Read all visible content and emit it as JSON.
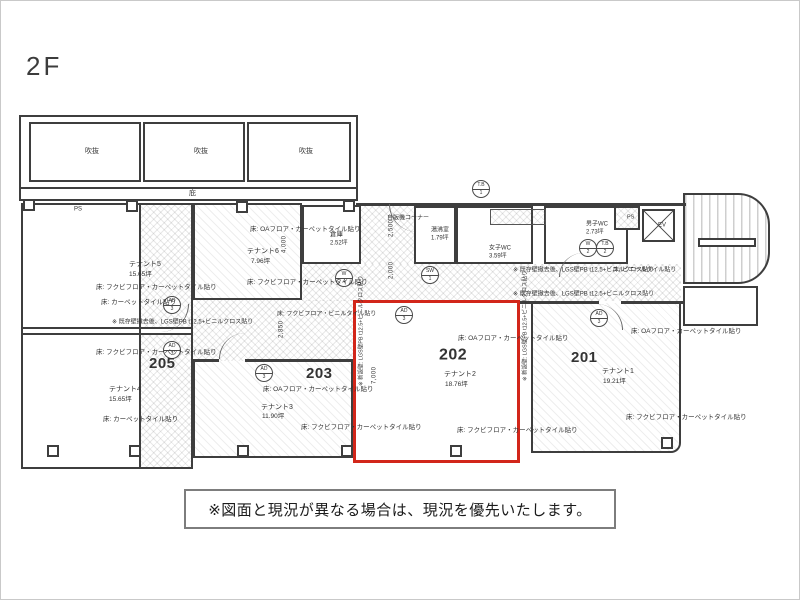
{
  "title": "2F",
  "disclaimer": "※図面と現況が異なる場合は、現況を優先いたします。",
  "labels": {
    "void": "吹抜",
    "canopy": "庇",
    "vending": "自販機コーナー",
    "ps": "PS",
    "ev": "EV",
    "vinyl_tile_floor": "床: ビニールタイル貼り",
    "vinyl_corridor_floor": "床: フクビフロア・ビニルタイル貼り",
    "demolish_note": "※ 既存壁撤去後、LGS壁PB t12.5+ビニルクロス貼り",
    "new_wall_note": "※ 新設壁: LGS壁PB t12.5+ビニルクロス貼り"
  },
  "tenants": {
    "t1": {
      "no": "201",
      "name": "テナント1",
      "area": "19.21坪",
      "floor_top": "床: OAフロア・カーペットタイル貼り",
      "floor_bottom": "床: フクビフロア・カーペットタイル貼り"
    },
    "t2": {
      "no": "202",
      "name": "テナント2",
      "area": "18.76坪",
      "floor_top": "床: OAフロア・カーペットタイル貼り",
      "floor_bottom": "床: フクビフロア・カーペットタイル貼り"
    },
    "t3": {
      "no": "203",
      "name": "テナント3",
      "area": "11.90坪",
      "floor_top": "床: OAフロア・カーペットタイル貼り",
      "floor_bottom": "床: フクビフロア・カーペットタイル貼り"
    },
    "t4": {
      "no": "205",
      "name": "テナント4",
      "area": "15.65坪",
      "floor_top": "床: フクビフロア・カーペットタイル貼り",
      "floor_bottom": "床: カーペットタイル貼り"
    },
    "t5": {
      "name": "テナント5",
      "area": "15.65坪",
      "floor_top": "床: フクビフロア・カーペットタイル貼り",
      "floor_bottom": "床: カーペットタイル貼り"
    },
    "t6": {
      "name": "テナント6",
      "area": "7.96坪",
      "floor_top": "床: OAフロア・カーペットタイル貼り",
      "floor_bottom": "床: フクビフロア・カーペットタイル貼り"
    }
  },
  "service": {
    "storage": {
      "name": "倉庫",
      "area": "2.52坪"
    },
    "kitchenette": {
      "name": "湯沸室",
      "area": "1.79坪"
    },
    "wc_women": {
      "name": "女子WC",
      "area": "3.59坪"
    },
    "wc_men": {
      "name": "男子WC",
      "area": "2.73坪"
    }
  },
  "dimensions": {
    "vending_upper": "2,500",
    "vending_lower": "2,000",
    "t6_depth": "4,000",
    "corridor_width": "2,850",
    "t2_width": "7,000"
  },
  "symbols": {
    "ad3": {
      "top": "AD",
      "bottom": "3"
    },
    "w4": {
      "top": "W",
      "bottom": "4"
    },
    "sw1": {
      "top": "SW",
      "bottom": "1"
    },
    "tb1": {
      "top": "T.B",
      "bottom": "1"
    },
    "w2": {
      "top": "W",
      "bottom": "2"
    },
    "tb2": {
      "top": "T.B",
      "bottom": "2"
    }
  },
  "colors": {
    "highlight_red": "#d2261a",
    "wall": "#3e3e3e"
  }
}
